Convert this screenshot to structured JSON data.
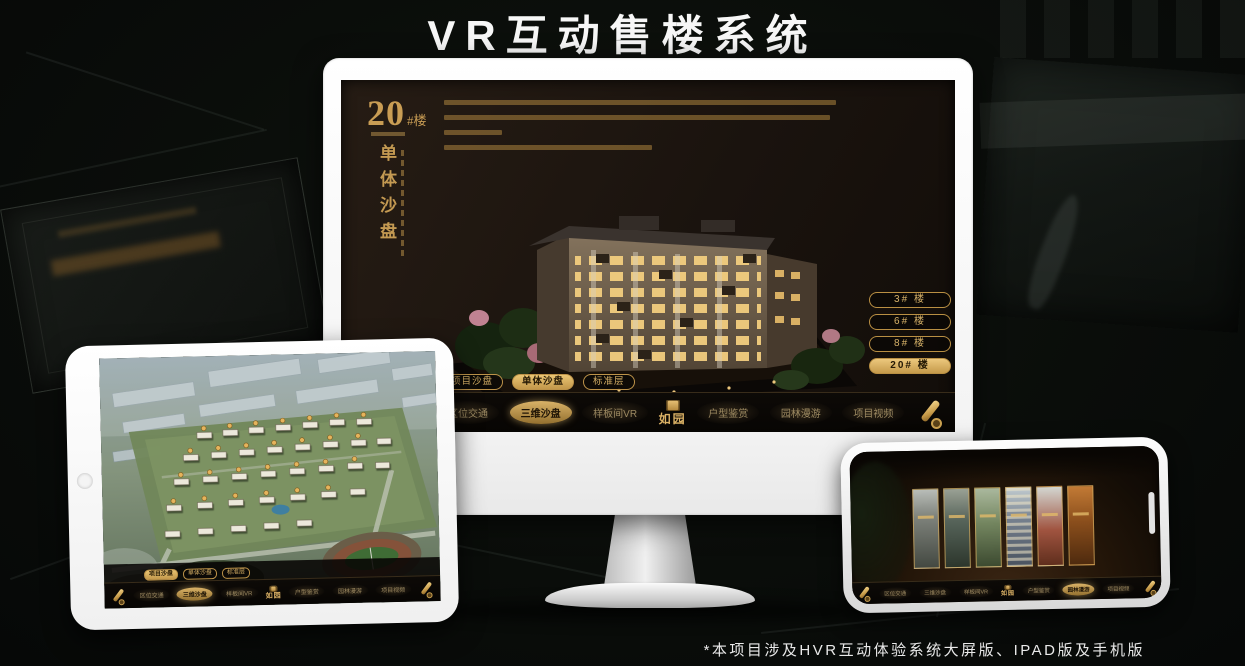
{
  "page": {
    "title": "VR互动售楼系统",
    "footnote": "*本项目涉及HVR互动体验系统大屏版、IPAD版及手机版"
  },
  "logo": {
    "name": "如园"
  },
  "nav_items": [
    "区位交通",
    "三维沙盘",
    "样板间VR",
    "户型鉴赏",
    "园林漫游",
    "项目视频"
  ],
  "sub_tabs": [
    "项目沙盘",
    "单体沙盘",
    "标准层"
  ],
  "monitor_screen": {
    "building_no": "20",
    "building_no_unit": "#楼",
    "vertical_title": "单体沙盘",
    "floor_buttons": [
      "3# 楼",
      "6# 楼",
      "8# 楼",
      "20# 楼"
    ],
    "selected_floor": "20# 楼",
    "selected_sub_tab": "单体沙盘",
    "selected_nav": "三维沙盘"
  },
  "tablet_screen": {
    "selected_sub_tab": "项目沙盘",
    "selected_nav": "三维沙盘"
  },
  "phone_screen": {
    "selected_nav": "园林漫游"
  },
  "colors": {
    "gold": "#d3a95f",
    "gold_selected": "#e8c479",
    "screen_background": "#1a130e"
  }
}
